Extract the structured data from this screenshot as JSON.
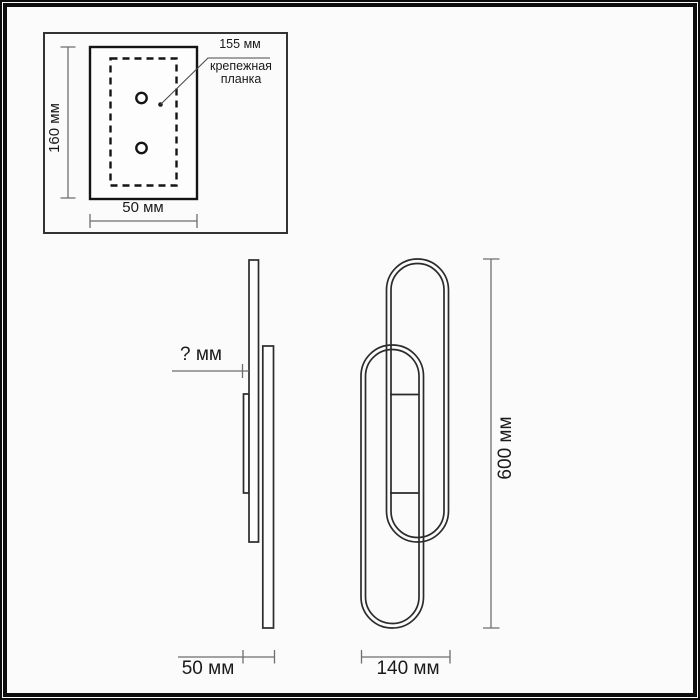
{
  "colors": {
    "outline": "#2b2b2b",
    "plate": "#141414",
    "dimension": "#6e6e6e",
    "text": "#1a1a1a",
    "background": "#fbfbfb",
    "frame": "#0d0d0d"
  },
  "inset": {
    "height_label": "160 мм",
    "width_label": "50 мм",
    "callout_value": "155 мм",
    "callout_name_line1": "крепежная",
    "callout_name_line2": "планка"
  },
  "side_view": {
    "depth_label": "? мм",
    "width_label": "50 мм"
  },
  "front_view": {
    "width_label": "140 мм",
    "height_label": "600 мм"
  }
}
